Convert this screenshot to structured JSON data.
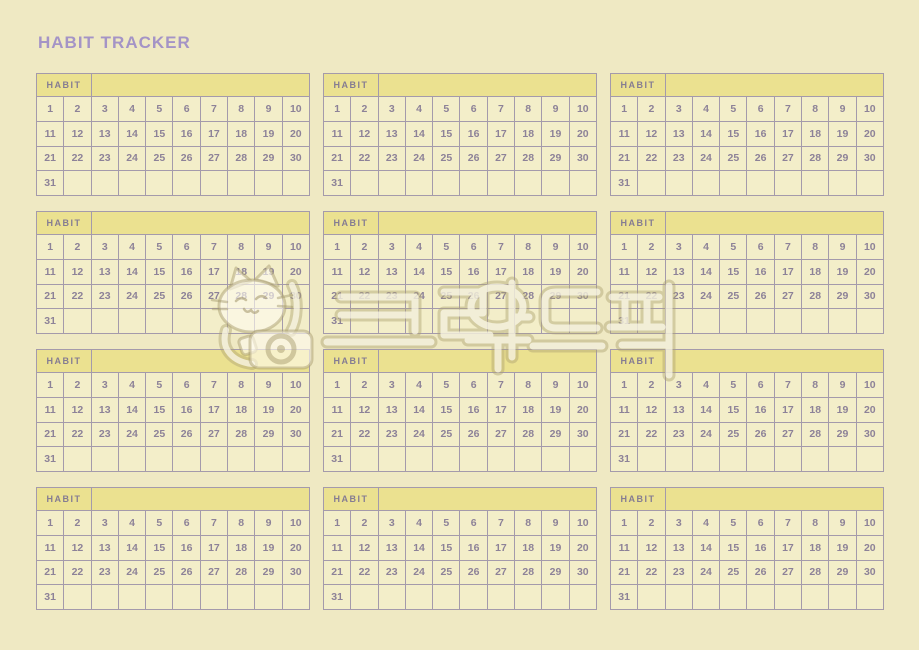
{
  "title": "HABIT TRACKER",
  "card": {
    "header_label": "HABIT",
    "rows": [
      [
        "1",
        "2",
        "3",
        "4",
        "5",
        "6",
        "7",
        "8",
        "9",
        "10"
      ],
      [
        "11",
        "12",
        "13",
        "14",
        "15",
        "16",
        "17",
        "18",
        "19",
        "20"
      ],
      [
        "21",
        "22",
        "23",
        "24",
        "25",
        "26",
        "27",
        "28",
        "29",
        "30"
      ],
      [
        "31",
        "",
        "",
        "",
        "",
        "",
        "",
        "",
        "",
        ""
      ]
    ]
  },
  "cards_count": 12,
  "grid": {
    "columns": 3,
    "rows": 4
  },
  "watermark": {
    "text": "크라우드픽",
    "mascot": "cat-with-camera"
  },
  "colors": {
    "page_bg": "#efe9c3",
    "cell_bg": "#f3eec9",
    "header_bg": "#ebe190",
    "border": "#a49aab",
    "number_text": "#8d8298",
    "header_text": "#857c92",
    "title_text": "#a494c6"
  }
}
